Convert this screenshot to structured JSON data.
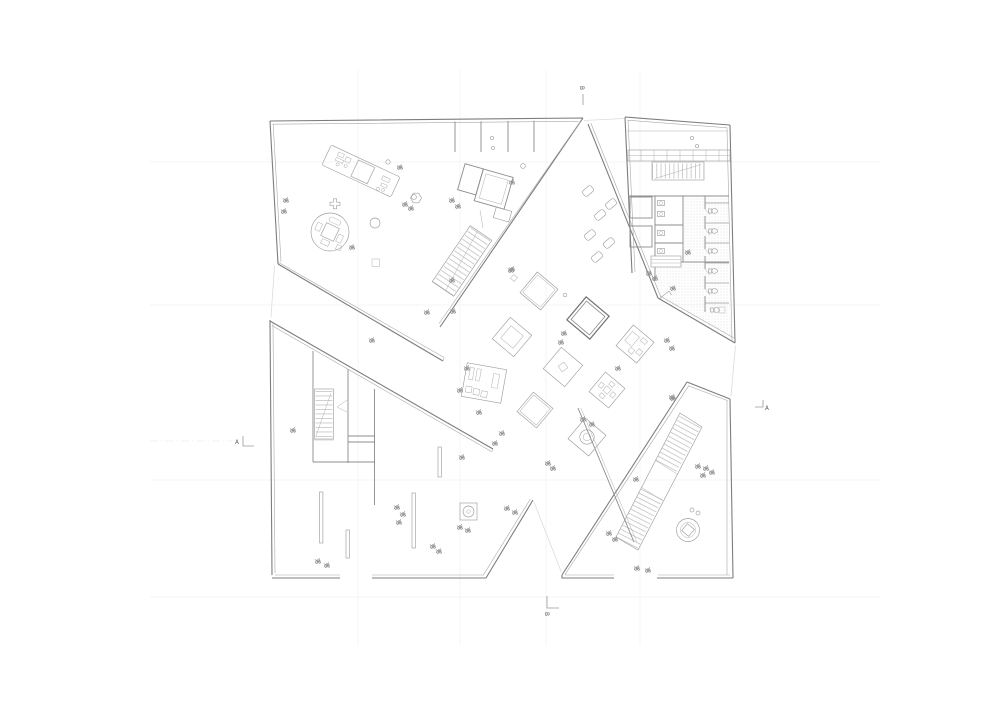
{
  "page": {
    "background_color": "#ffffff"
  },
  "plan": {
    "drawing_type": "architectural floor plan",
    "wall_color": "#7d7d7d",
    "detail_color": "#9e9e9e",
    "faint_grid_color": "#ededed",
    "section_markers": [
      {
        "position": "top",
        "label": "B"
      },
      {
        "position": "bottom",
        "label": "B"
      },
      {
        "position": "left",
        "label": "A"
      },
      {
        "position": "right",
        "label": "A"
      }
    ]
  }
}
